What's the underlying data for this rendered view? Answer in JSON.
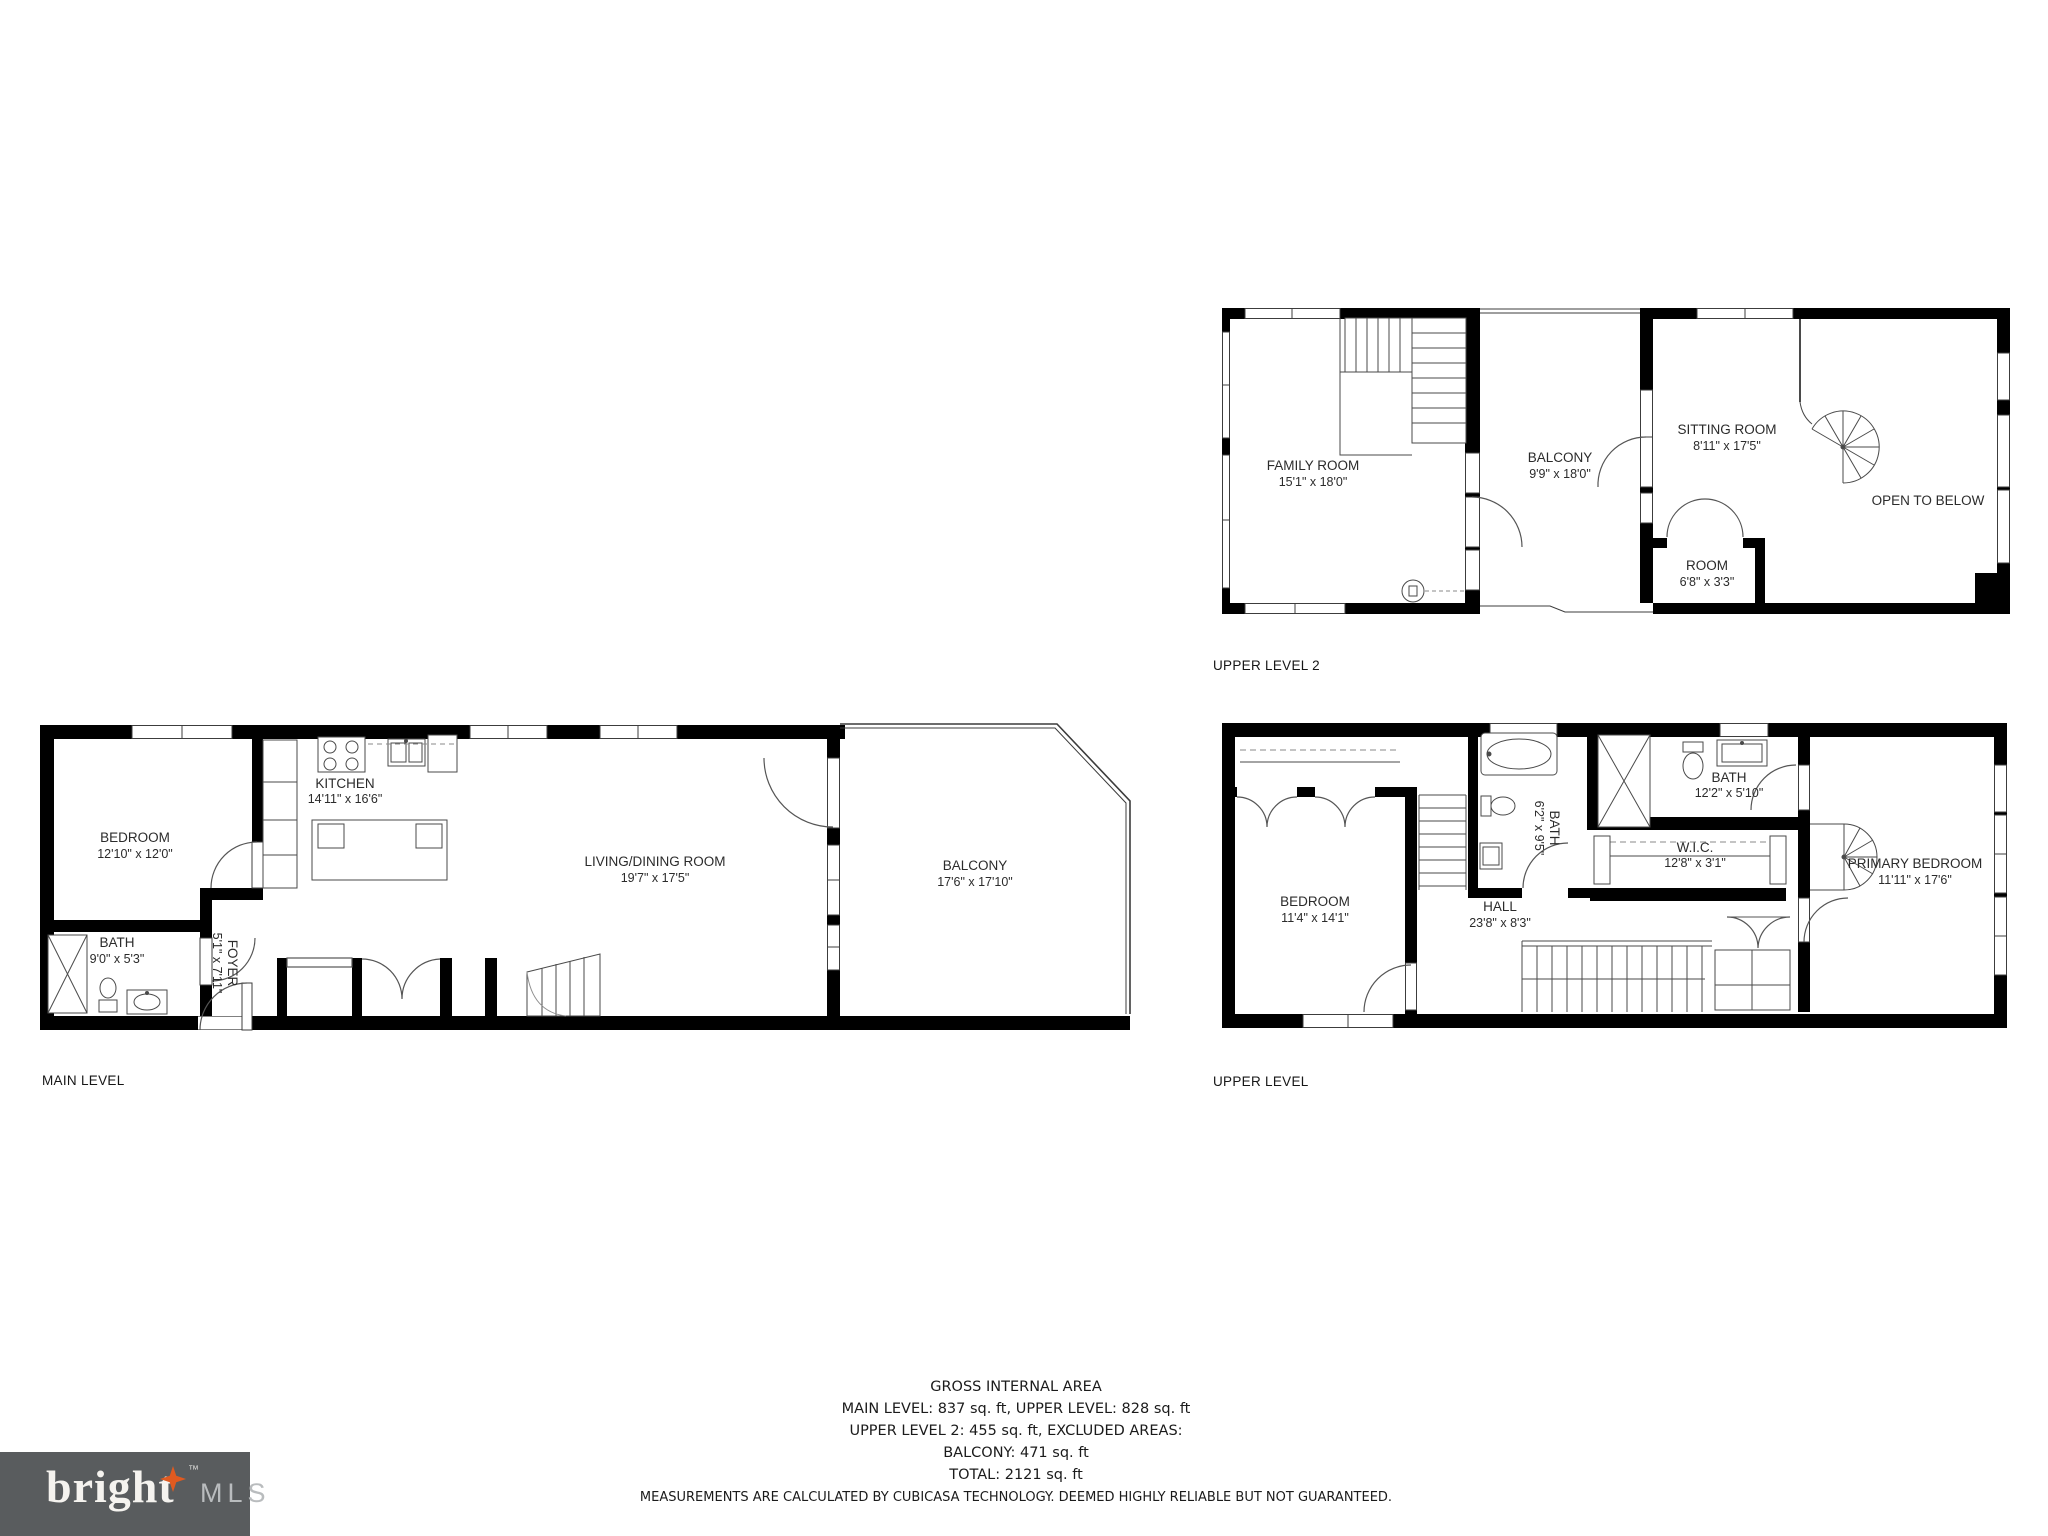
{
  "plans": {
    "main": {
      "label": "MAIN LEVEL",
      "rooms": {
        "bedroom": {
          "name": "BEDROOM",
          "dims": "12'10\" x 12'0\""
        },
        "bath": {
          "name": "BATH",
          "dims": "9'0\" x 5'3\""
        },
        "foyer": {
          "name": "FOYER",
          "dims": "5'1\" x 7'11\""
        },
        "kitchen": {
          "name": "KITCHEN",
          "dims": "14'11\" x 16'6\""
        },
        "living": {
          "name": "LIVING/DINING ROOM",
          "dims": "19'7\" x 17'5\""
        },
        "balcony": {
          "name": "BALCONY",
          "dims": "17'6\" x 17'10\""
        }
      }
    },
    "upper": {
      "label": "UPPER LEVEL",
      "rooms": {
        "bedroom": {
          "name": "BEDROOM",
          "dims": "11'4\" x 14'1\""
        },
        "bath": {
          "name": "BATH",
          "dims": "6'2\" x 9'5\""
        },
        "hall": {
          "name": "HALL",
          "dims": "23'8\" x 8'3\""
        },
        "bath2": {
          "name": "BATH",
          "dims": "12'2\" x 5'10\""
        },
        "wic": {
          "name": "W.I.C.",
          "dims": "12'8\" x 3'1\""
        },
        "primary": {
          "name": "PRIMARY BEDROOM",
          "dims": "11'11\" x 17'6\""
        }
      }
    },
    "upper2": {
      "label": "UPPER LEVEL 2",
      "rooms": {
        "family": {
          "name": "FAMILY ROOM",
          "dims": "15'1\" x 18'0\""
        },
        "balcony": {
          "name": "BALCONY",
          "dims": "9'9\" x 18'0\""
        },
        "sitting": {
          "name": "SITTING ROOM",
          "dims": "8'11\" x 17'5\""
        },
        "room": {
          "name": "ROOM",
          "dims": "6'8\" x 3'3\""
        },
        "open": {
          "name": "OPEN TO BELOW"
        }
      }
    }
  },
  "footer": {
    "title": "GROSS INTERNAL AREA",
    "line1": "MAIN LEVEL: 837 sq. ft, UPPER LEVEL: 828 sq. ft",
    "line2": "UPPER LEVEL 2: 455 sq. ft, EXCLUDED AREAS:",
    "line3": "BALCONY: 471 sq. ft",
    "line4": "TOTAL: 2121 sq. ft",
    "disclaimer": "MEASUREMENTS ARE CALCULATED BY CUBICASA TECHNOLOGY. DEEMED HIGHLY RELIABLE BUT NOT GUARANTEED."
  },
  "logo": {
    "brand": "bright",
    "tm": "™",
    "suffix": "MLS",
    "colors": {
      "background": "#595c5e",
      "star": "#e05a20",
      "brand_text": "#f5f3ef",
      "suffix_text": "#b9bcbe"
    }
  }
}
